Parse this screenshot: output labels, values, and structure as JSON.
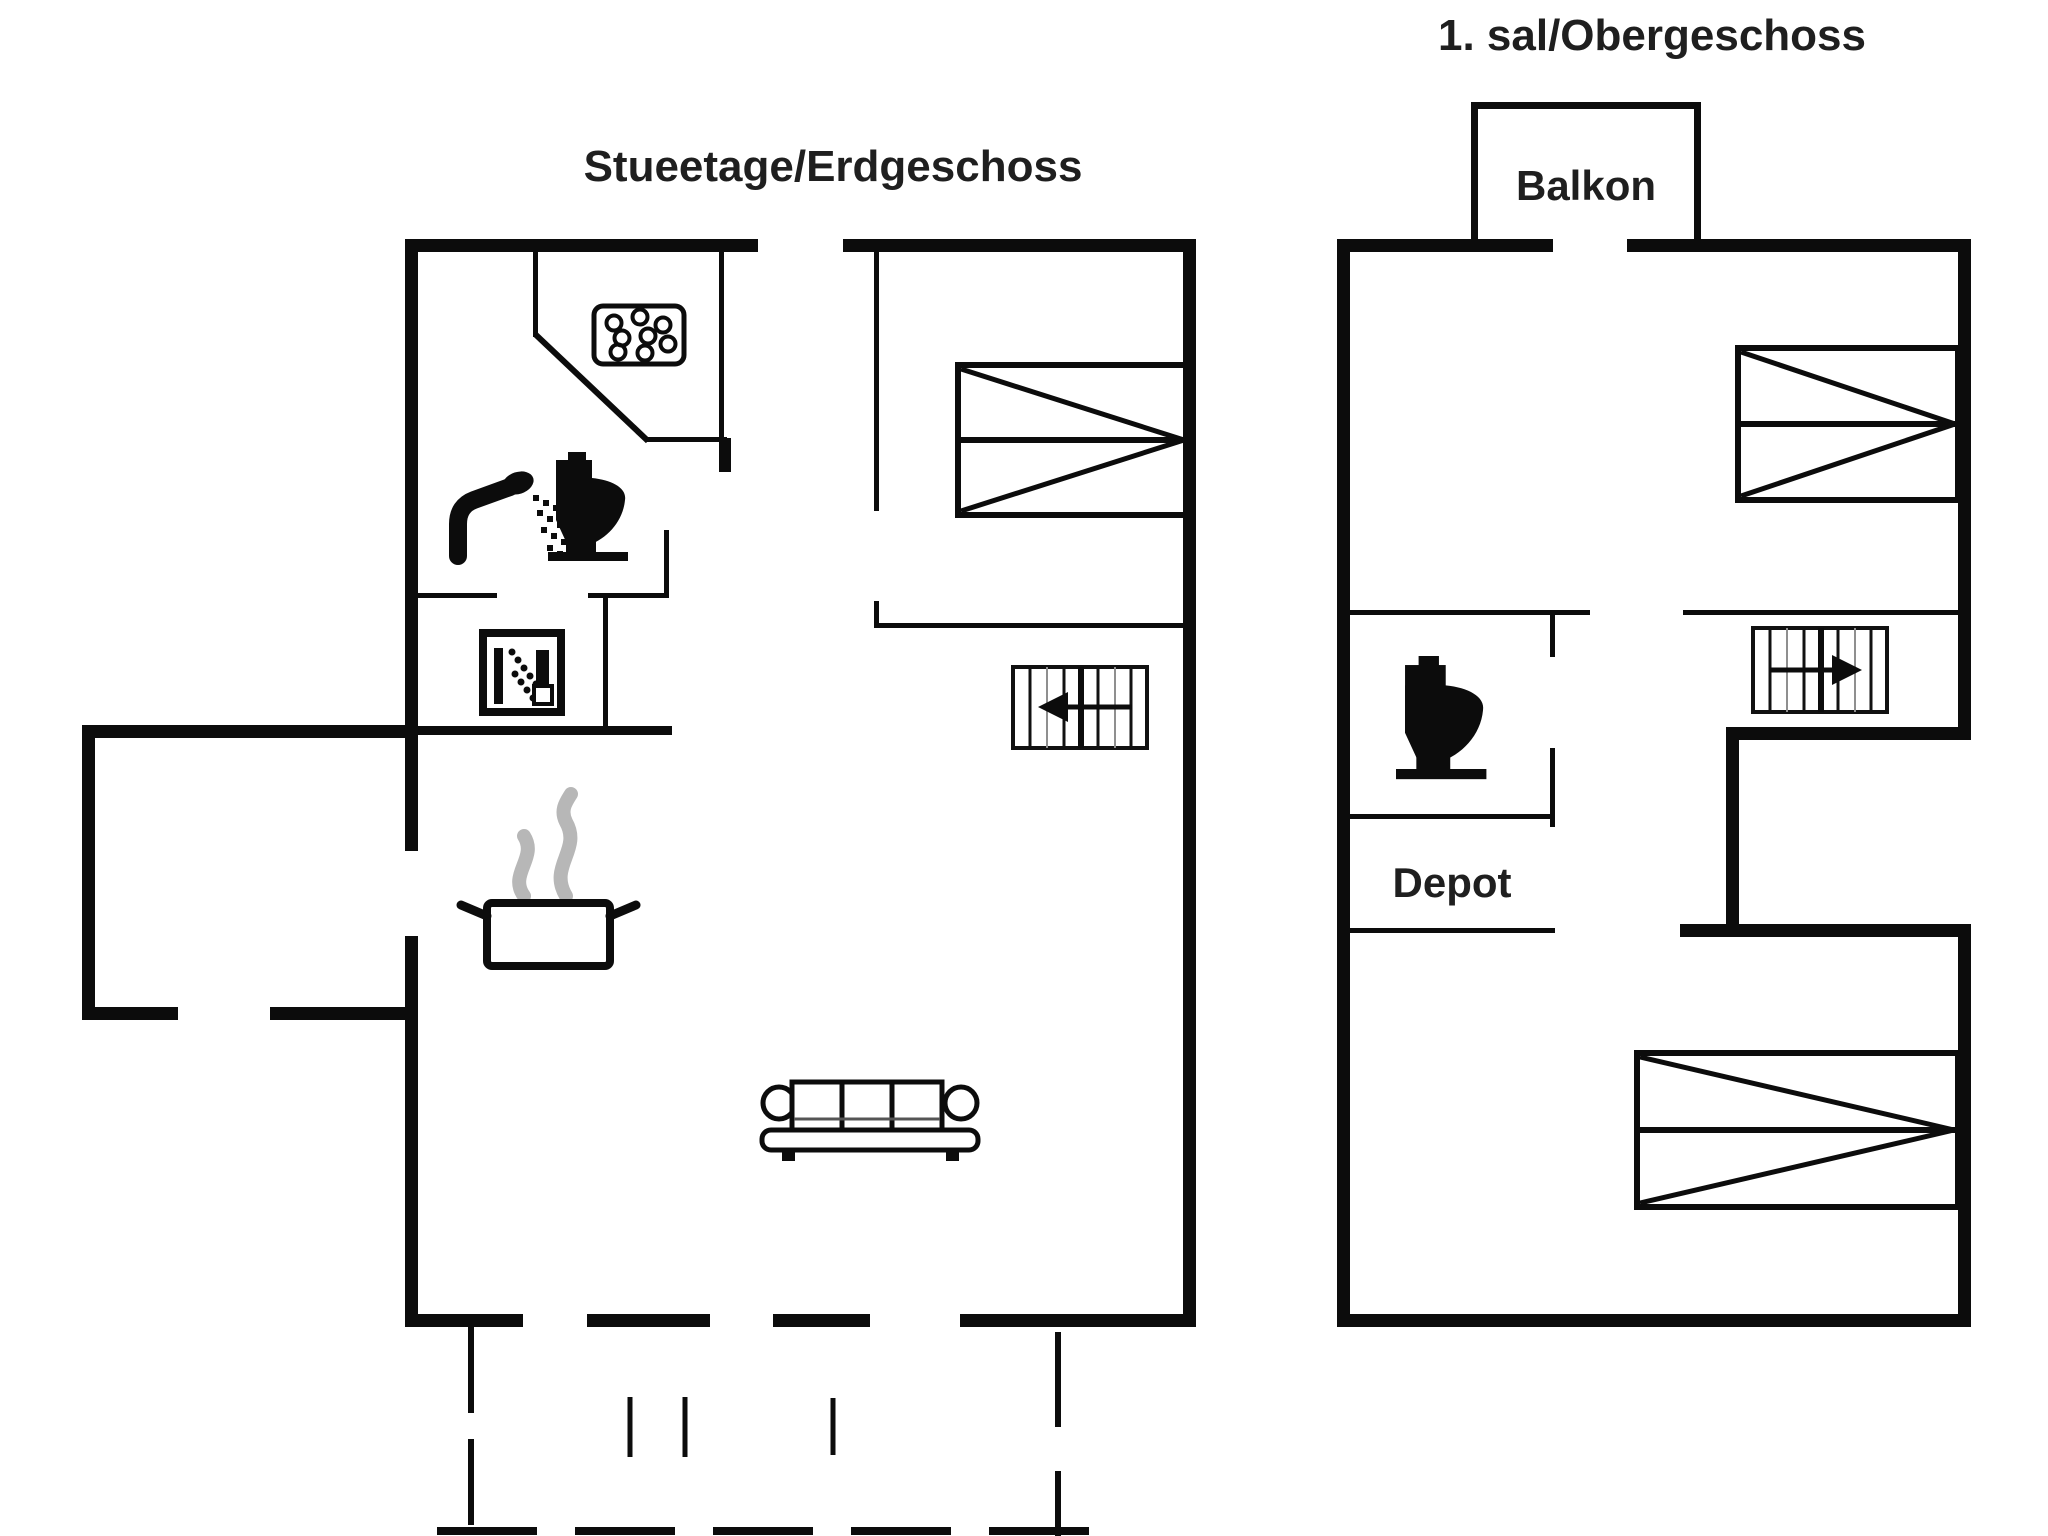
{
  "document": {
    "background_color": "#ffffff",
    "line_color": "#0c0c0c",
    "text_color": "#1f1f1f",
    "steam_color": "#b7b7b7",
    "stair_tread_color": "#8f8f8f"
  },
  "ground_floor": {
    "title": "Stueetage/Erdgeschoss",
    "icons": [
      "whirlpool-icon",
      "shower-icon",
      "toilet-icon",
      "shower-cabin-icon",
      "cooking-pot-icon",
      "stairs-icon",
      "double-bed-icon",
      "sofa-icon"
    ]
  },
  "upper_floor": {
    "title": "1. sal/Obergeschoss",
    "balcony_label": "Balkon",
    "storage_label": "Depot",
    "icons": [
      "toilet-icon",
      "stairs-icon",
      "double-bed-icon",
      "double-bed-icon"
    ]
  }
}
